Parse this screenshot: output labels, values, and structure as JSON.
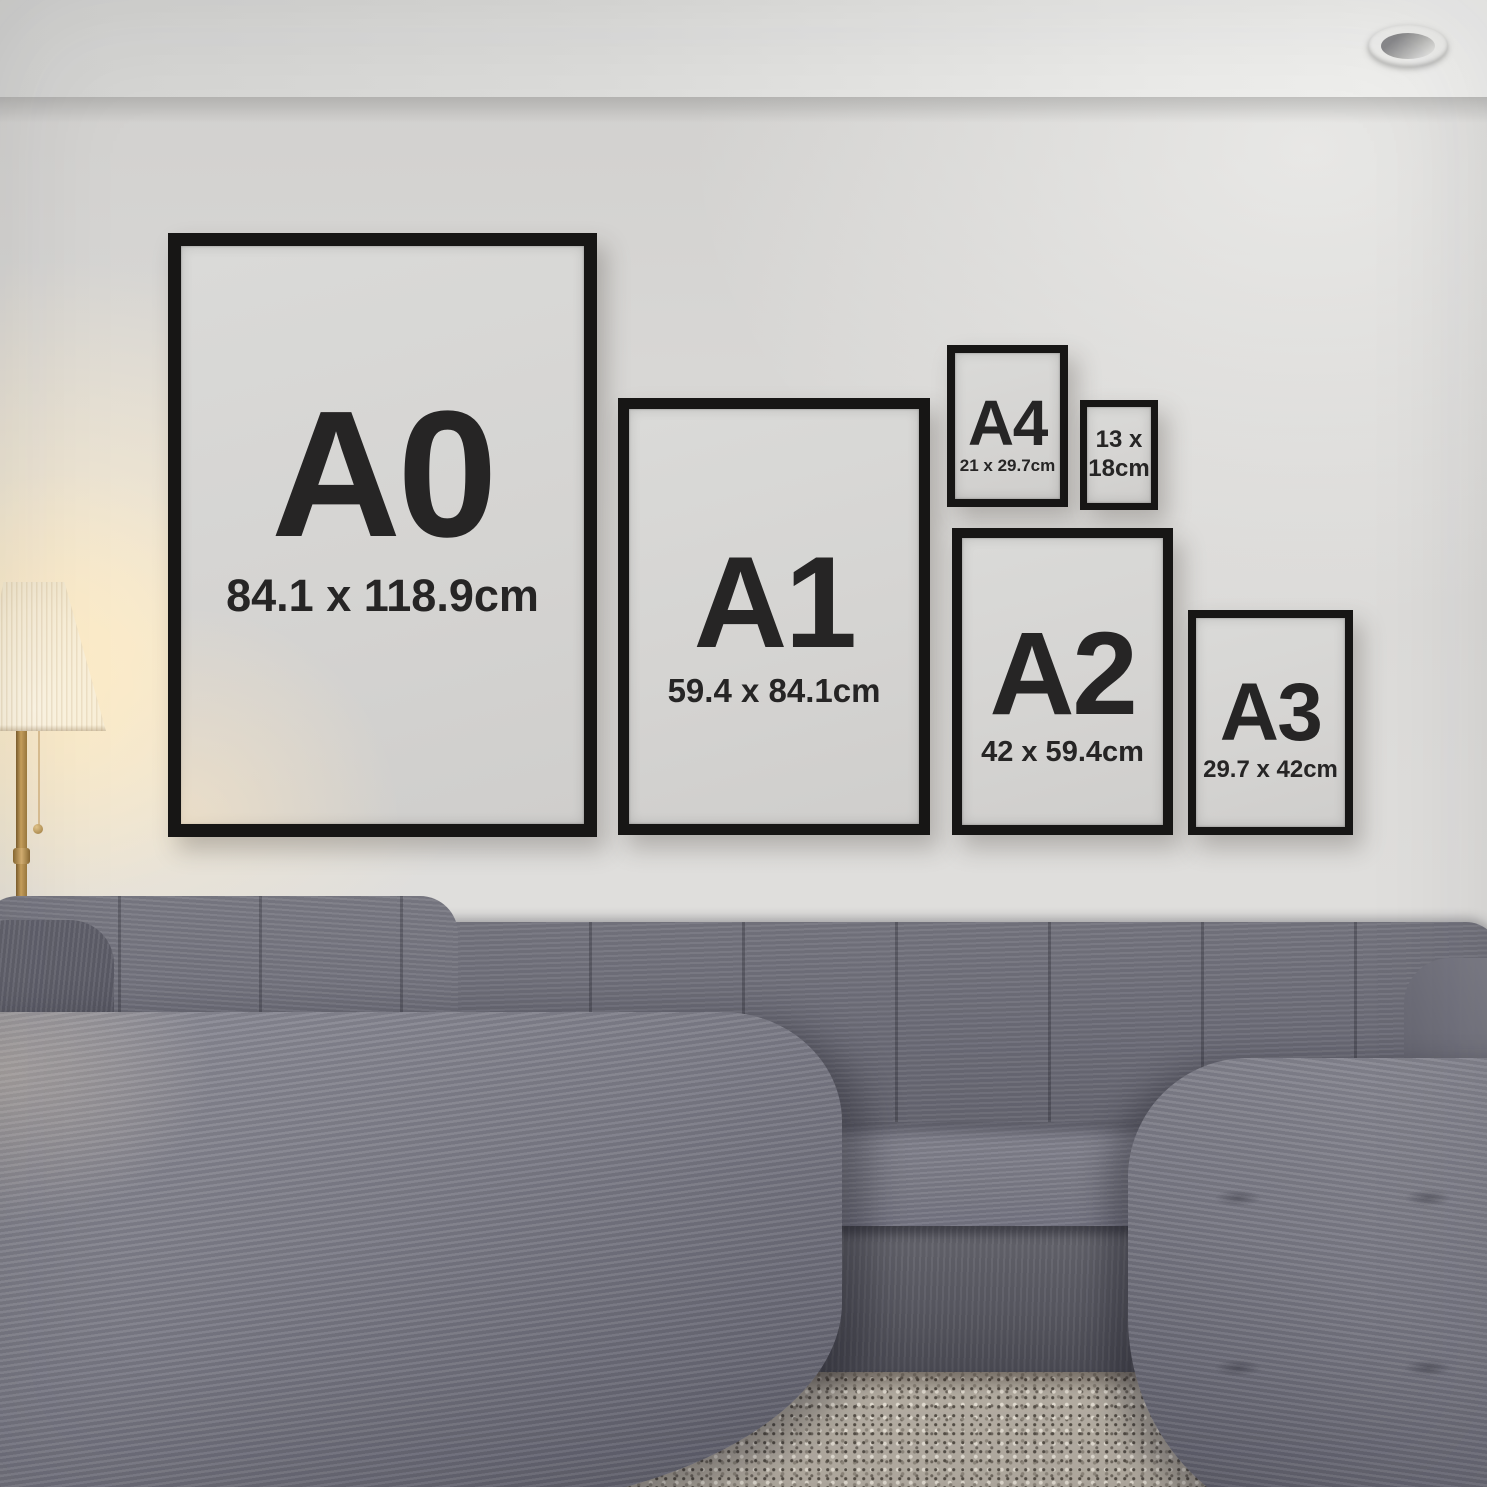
{
  "poster_frames": [
    {
      "name": "A0",
      "label": "A0",
      "size_text": "84.1 x 118.9cm"
    },
    {
      "name": "A1",
      "label": "A1",
      "size_text": "59.4 x 84.1cm"
    },
    {
      "name": "A4",
      "label": "A4",
      "size_text": "21 x 29.7cm"
    },
    {
      "name": "13x18cm",
      "label": "13 x",
      "size_text": "18cm"
    },
    {
      "name": "A2",
      "label": "A2",
      "size_text": "42 x 59.4cm"
    },
    {
      "name": "A3",
      "label": "A3",
      "size_text": "29.7 x 42cm"
    }
  ],
  "palette": {
    "frame_border": "#171615",
    "poster_paper": "#d5d4d2",
    "poster_text": "#262525",
    "wall": "#d8d7d5",
    "ceiling": "#e7e7e5",
    "lamp_shade": "#f9efd8",
    "lamp_glow": "#ffecc4",
    "lamp_pole_brass": "#caa25e",
    "sofa_gray": "#73737f",
    "sofa_shadow": "#55555f",
    "rug": "#b4ada2",
    "floor_dark": "#34271f"
  }
}
